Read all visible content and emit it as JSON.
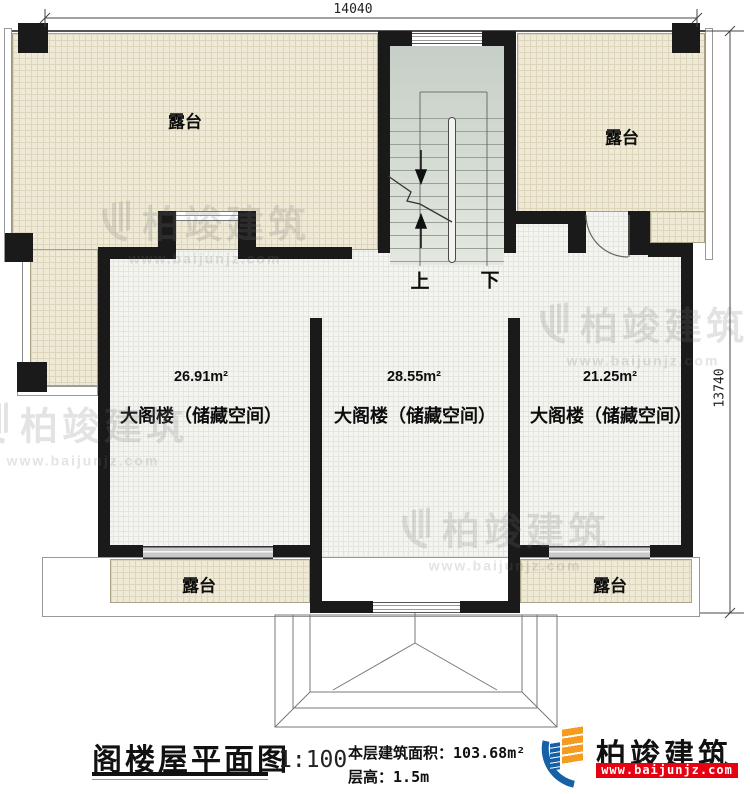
{
  "dimensions": {
    "top": "14040",
    "right": "13740"
  },
  "stairs": {
    "up": "上",
    "down": "下"
  },
  "labels": {
    "terrace": "露台"
  },
  "rooms": [
    {
      "area": "26.91m²",
      "label": "大阁楼（储藏空间）"
    },
    {
      "area": "28.55m²",
      "label": "大阁楼（储藏空间）"
    },
    {
      "area": "21.25m²",
      "label": "大阁楼（储藏空间）"
    }
  ],
  "titleblock": {
    "title": "阁楼屋平面图",
    "scale": "1:100",
    "area_label": "本层建筑面积：",
    "area_value": "103.68m²",
    "height_label": "层高：",
    "height_value": "1.5m"
  },
  "brand": {
    "name": "柏竣建筑",
    "url": "www.baijunjz.com"
  },
  "icons": {
    "brand_logo": "building-with-swoosh"
  },
  "colors": {
    "wall": "#1a1a1a",
    "terrace_fill": "#eeead7",
    "room_fill": "#f4f4f1",
    "stair_fill": "#d5dcd3",
    "brand_red": "#e60012",
    "brand_blue": "#1660a7",
    "brand_orange": "#f49c1f"
  }
}
